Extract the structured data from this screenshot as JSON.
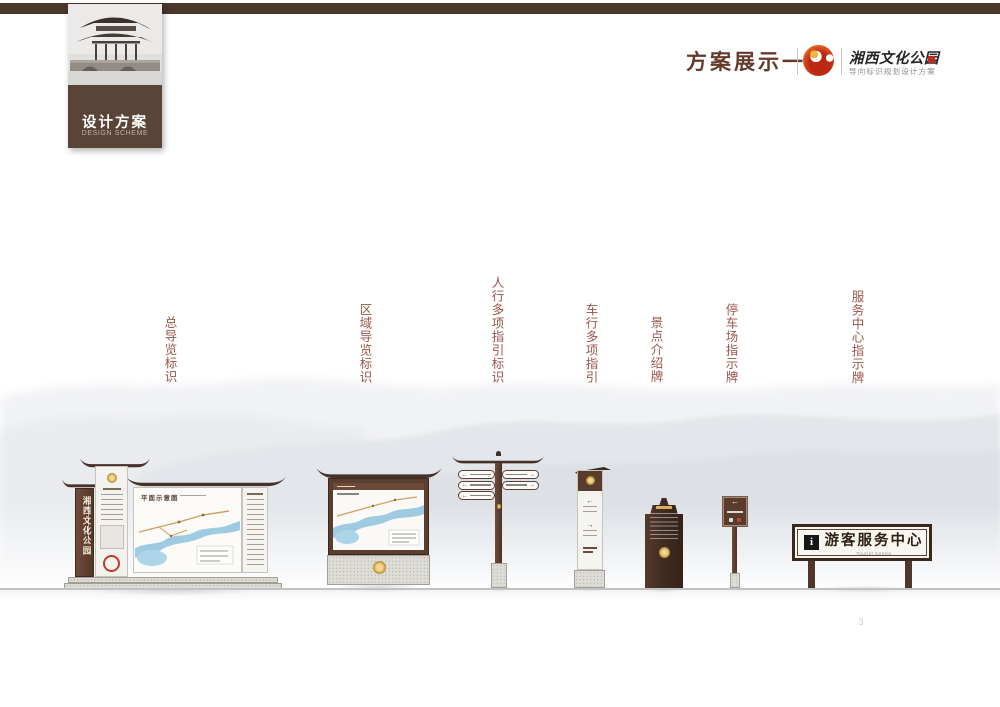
{
  "colors": {
    "accent_brown": "#4a362a",
    "tab_brown": "#5a4337",
    "title_brown": "#643a2a",
    "label_red": "#9a564a",
    "sign_brown": "#5a3f30",
    "gold": "#c9a24b",
    "river_blue": "#9fcbe2",
    "seal_red": "#bf2c1e"
  },
  "sidebar_tab": {
    "title_cn": "设计方案",
    "title_en": "DESIGN SCHEME"
  },
  "header": {
    "section_title": "方案展示一",
    "brand_name": "湘西文化公园",
    "brand_subtitle": "导向标识规划设计方案"
  },
  "sign_labels": [
    "总导览标识",
    "区域导览标识",
    "人行多项指引标识",
    "车行多项指引",
    "景点介绍牌",
    "停车场指示牌",
    "服务中心指示牌"
  ],
  "signs": {
    "main_guide": {
      "side_panel_text": "湘西文化公园",
      "map_title": "平面示意图"
    },
    "pedestrian_fingerpost": {
      "arrow_left": "←",
      "arrow_right": "→"
    },
    "vehicle_sign": {
      "arrow_left": "←",
      "arrow_right": "→"
    },
    "parking_sign": {
      "arrow": "←"
    },
    "service_center_sign": {
      "info_symbol": "i",
      "title": "游客服务中心",
      "subtitle": "Tourist Centre"
    }
  },
  "page_number": "3"
}
